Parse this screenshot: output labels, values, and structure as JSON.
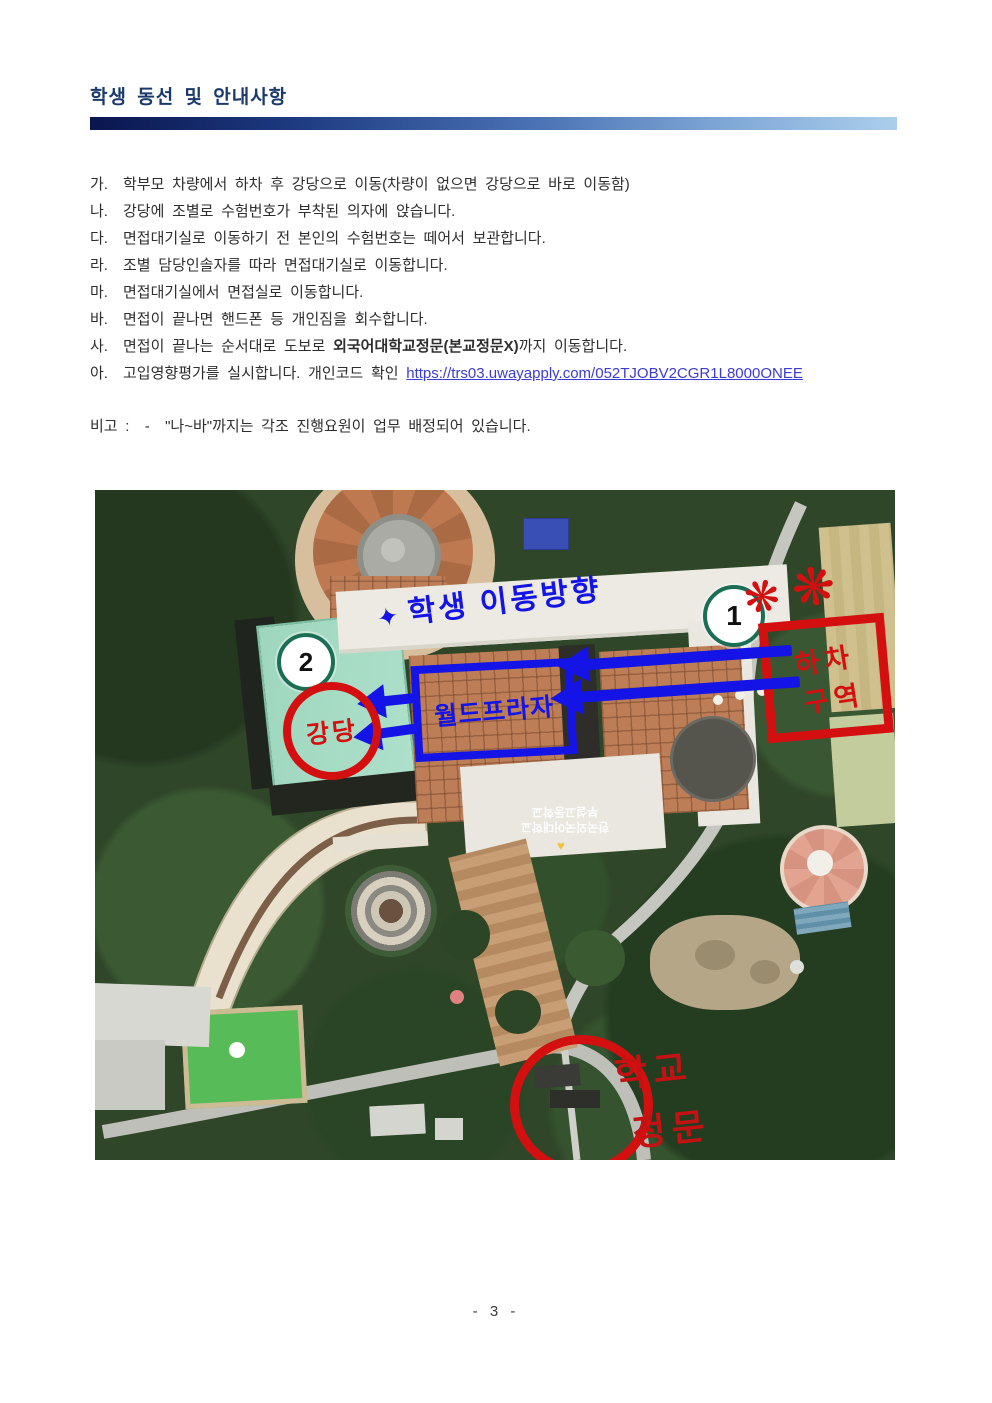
{
  "page": {
    "number": "- 3 -"
  },
  "header": {
    "title": "학생 동선 및 안내사항"
  },
  "instructions": {
    "items": [
      {
        "label": "가.",
        "text": "학부모 차량에서 하차 후 강당으로 이동(차량이 없으면 강당으로 바로 이동함)"
      },
      {
        "label": "나.",
        "text": "강당에 조별로 수험번호가 부착된 의자에 앉습니다."
      },
      {
        "label": "다.",
        "text": "면접대기실로 이동하기 전 본인의 수험번호는 떼어서 보관합니다."
      },
      {
        "label": "라.",
        "text": "조별 담당인솔자를 따라 면접대기실로 이동합니다."
      },
      {
        "label": "마.",
        "text": "면접대기실에서 면접실로 이동합니다."
      },
      {
        "label": "바.",
        "text": "면접이 끝나면 핸드폰 등 개인짐을 회수합니다."
      },
      {
        "label": "사.",
        "text_before": "면접이 끝나는 순서대로 도보로 ",
        "bold": "외국어대학교정문(본교정문X)",
        "text_after": "까지 이동합니다."
      },
      {
        "label": "아.",
        "text_before": "고입영향평가를 실시합니다. 개인코드 확인 ",
        "link_text": "https://trs03.uwayapply.com/052TJOBV2CGR1L8000ONEE"
      }
    ],
    "note": "비고 :  -  \"나~바\"까지는 각조 진행요원이 업무 배정되어 있습니다."
  },
  "map": {
    "direction_star": "✦",
    "direction_title": "학생 이동방향",
    "marker1": "1",
    "marker2": "2",
    "flower_mark": "❋",
    "dropoff_line1": "하차",
    "dropoff_line2": "구역",
    "plaza_box": "월드프라자",
    "auditorium": "강당",
    "gate_line1": "학교",
    "gate_line2": "정문",
    "rooftop_line1": "한국외국어대학교",
    "rooftop_line2": "부설고등학교",
    "rooftop_heart": "♥",
    "colors": {
      "annotation_blue": "#1414e6",
      "annotation_red": "#d40f0f",
      "marker_ring": "#1b6e54",
      "header_navy": "#1b3a6b"
    }
  }
}
